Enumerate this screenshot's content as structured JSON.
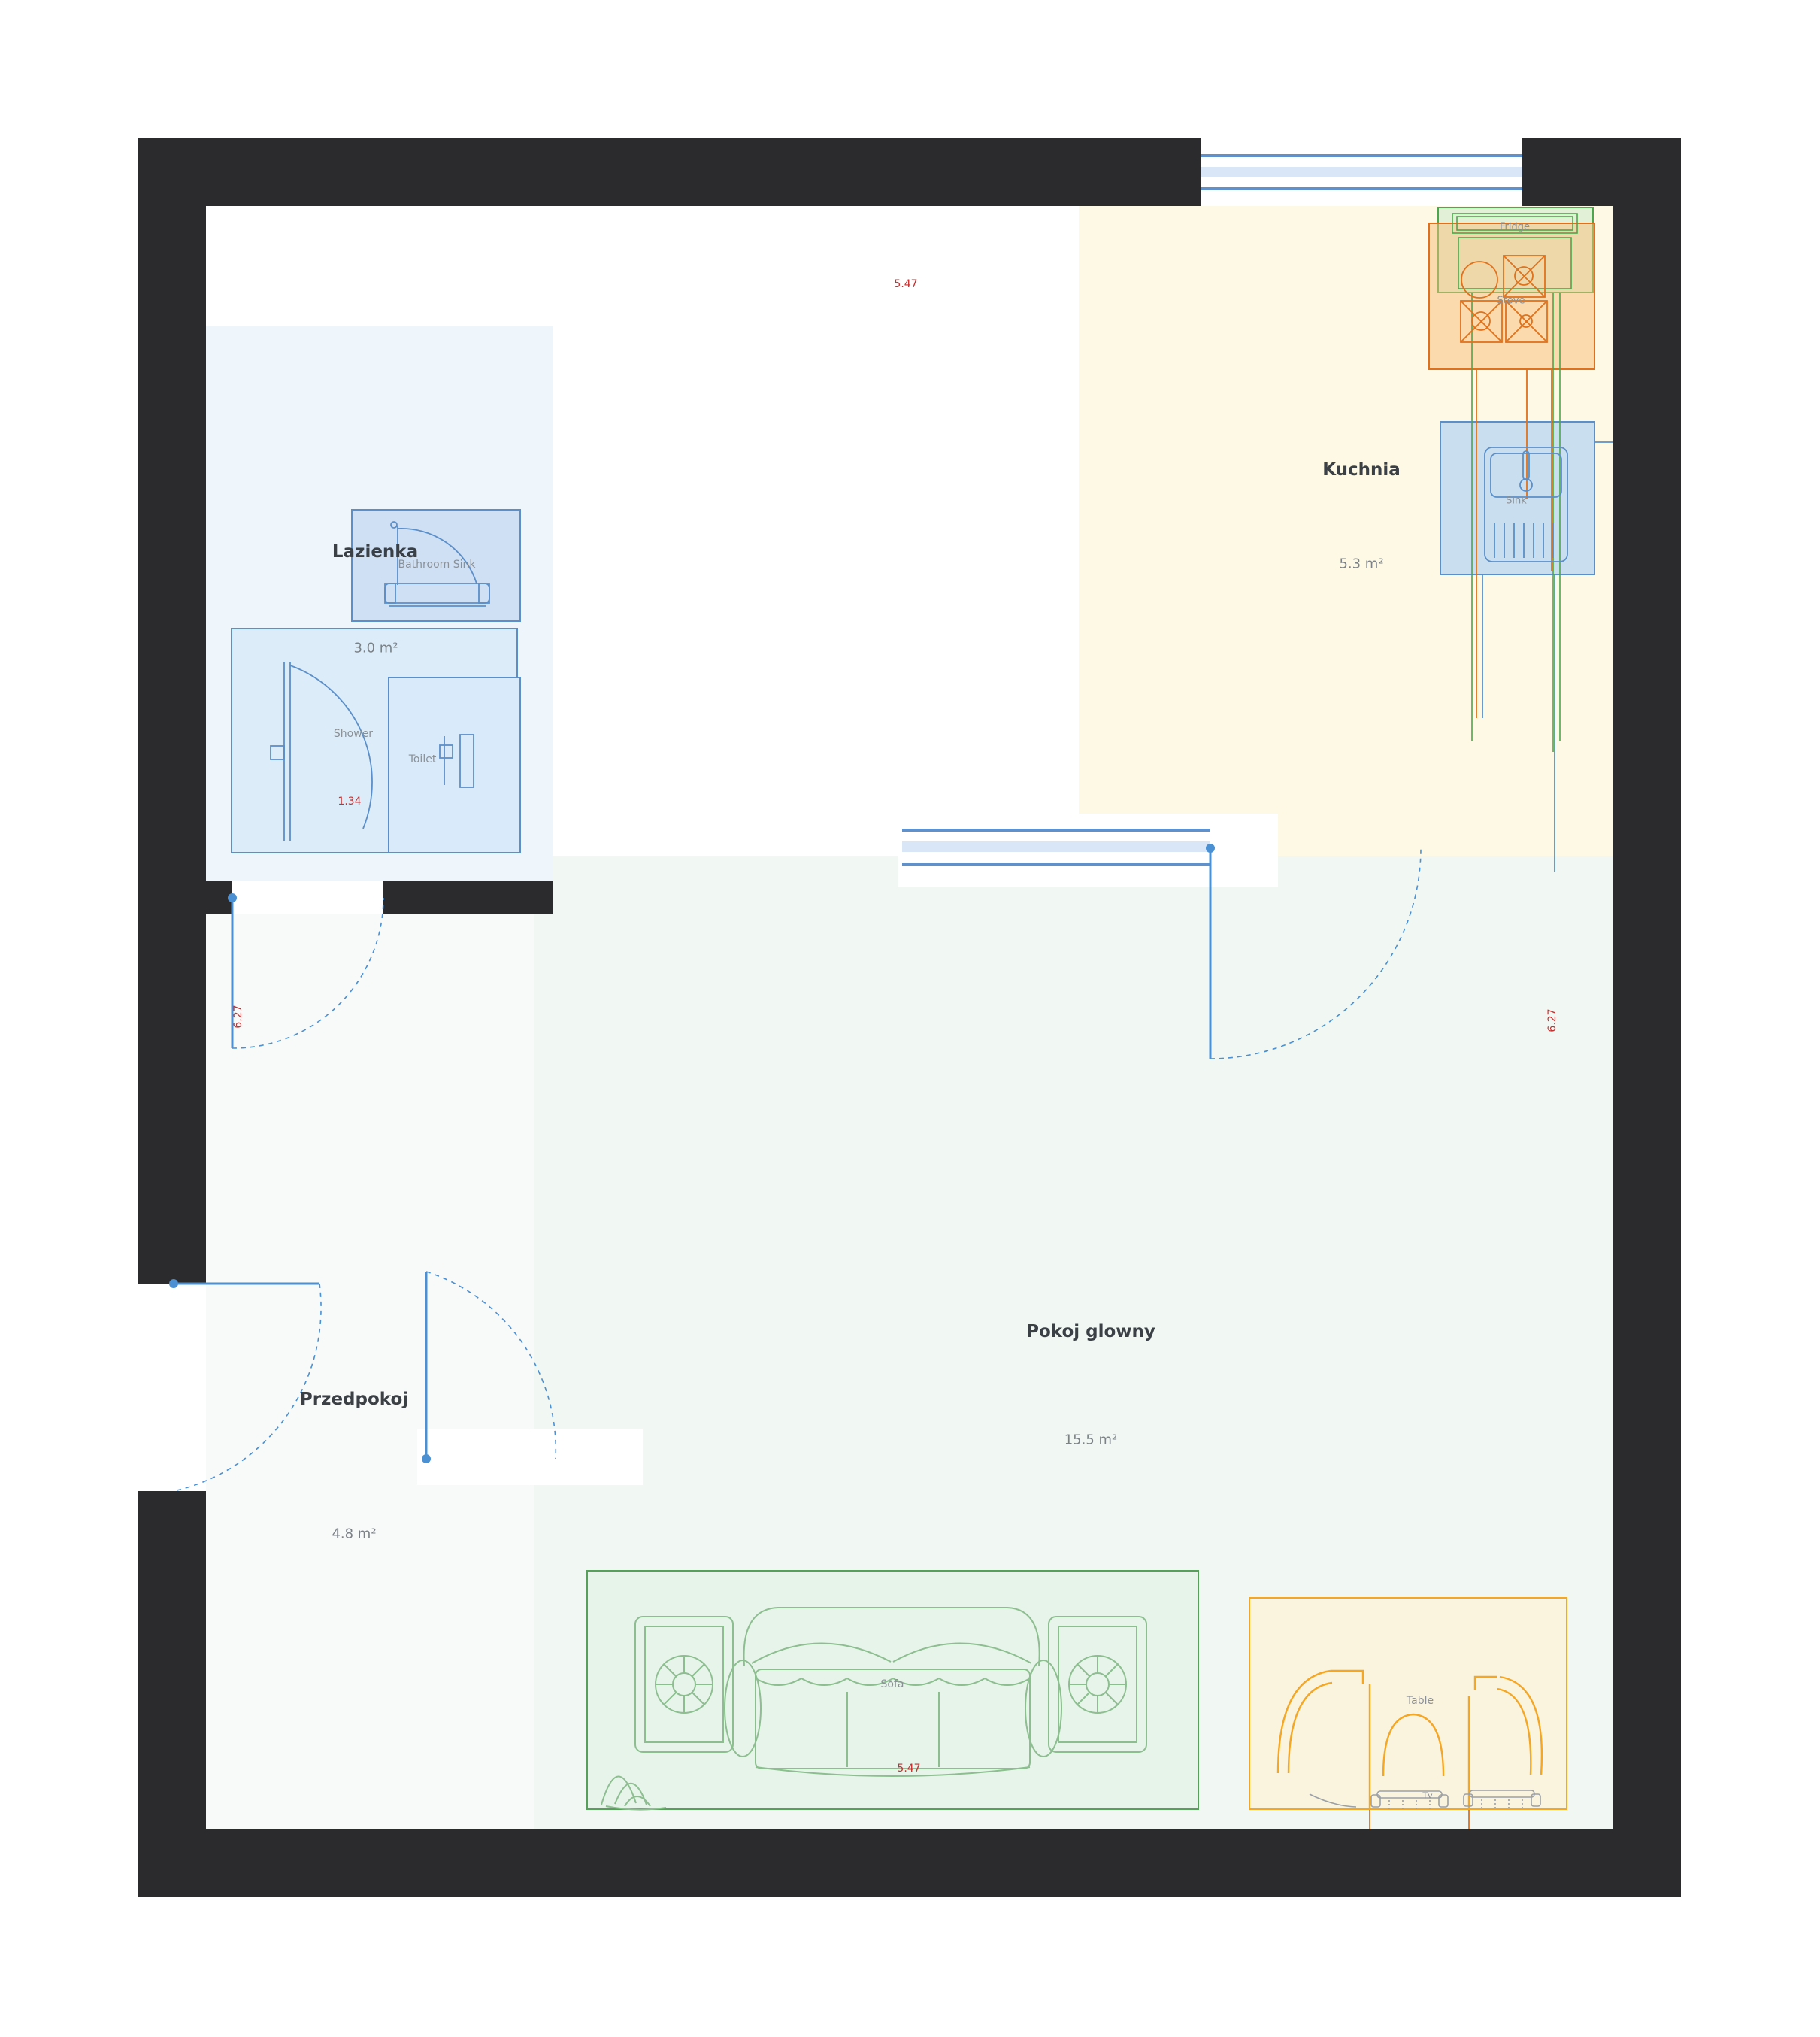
{
  "theme": {
    "wall": "#2b2b2d",
    "floor-bath": "#eef6fc",
    "floor-kitchen": "#fdf9e4",
    "floor-main": "#f1f8f3",
    "floor-hall": "#f8f9f9",
    "window-line": "#5f92cc",
    "window-band": "#d9e6f8",
    "door": "#4a90d2",
    "dim": "#c53030",
    "title": "#3b4046",
    "muted": "#8b9096",
    "area": "#7b8187",
    "green-stroke": "#4ca64c",
    "orange-stroke": "#e0711c",
    "blue-stroke": "#5b8fc9",
    "sofa-stroke": "#57a05a",
    "table-stroke": "#f5a623",
    "sketch-green": "#8cbe8f",
    "sketch-grey": "#9aa0a6"
  },
  "rooms": {
    "lazienka": {
      "name": "Lazienka",
      "area": "3.0 m²"
    },
    "kuchnia": {
      "name": "Kuchnia",
      "area": "5.3 m²"
    },
    "przedpokoj": {
      "name": "Przedpokoj",
      "area": "4.8 m²"
    },
    "pokoj": {
      "name": "Pokoj glowny",
      "area": "15.5 m²"
    }
  },
  "fixtures": {
    "bathroom_sink": "Bathroom Sink",
    "shower": "Shower",
    "toilet": "Toilet",
    "fridge": "Fridge",
    "stove": "Stove",
    "sink": "Sink",
    "sofa": "Sofa",
    "table": "Table",
    "tv": "Tv"
  },
  "dimensions": {
    "width_top": "5.47",
    "width_bottom": "5.47",
    "height_left": "6.27",
    "height_right": "6.27",
    "bath_width": "1.34"
  }
}
